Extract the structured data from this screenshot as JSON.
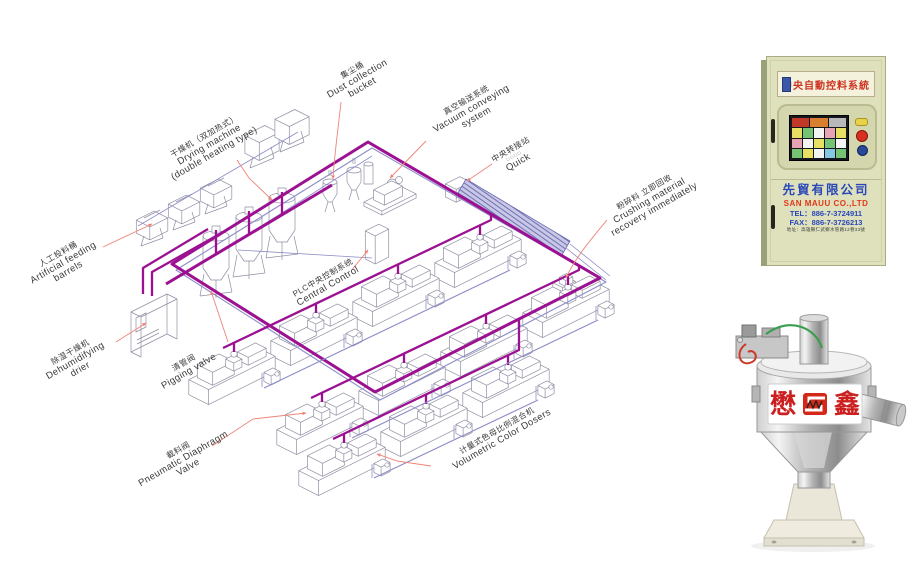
{
  "page_background": "#ffffff",
  "colors": {
    "pipe_main": "#9c1191",
    "pipe_return": "#8c8cc8",
    "leader": "#ef8377",
    "machine_outline": "#8f8fa3"
  },
  "diagram": {
    "labels": {
      "drying": {
        "zh": "干燥机（双加热式）",
        "en1": "Drying machine",
        "en2": "(double heating type)"
      },
      "dust_collection": {
        "zh": "集尘桶",
        "en1": "Dust collection",
        "en2": "bucket"
      },
      "vacuum": {
        "zh": "真空输送系统",
        "en1": "Vacuum conveying",
        "en2": "system"
      },
      "transfer": {
        "zh": "中央转接站",
        "sub": "□□□□",
        "en1": "Quick"
      },
      "artificial": {
        "zh": "人工投料桶",
        "en1": "Artificial feeding",
        "en2": "barrels"
      },
      "dehumidifying": {
        "zh": "除湿干燥机",
        "en1": "Dehumidifying",
        "en2": "drier"
      },
      "pigging": {
        "zh": "清管阀",
        "en1": "Pigging valve"
      },
      "central_control": {
        "zh": "PLC中央控制系统",
        "en1": "Central Control"
      },
      "crushing": {
        "zh": "粉碎料 立即回收",
        "en1": "Crushing material",
        "en2": "recovery immediately"
      },
      "pneumatic": {
        "zh": "截料阀",
        "en1": "Pneumatic Diaphragm",
        "en2": "Valve"
      },
      "color_dosers": {
        "zh": "计量式色母比例混合机",
        "en1": "Volumetric Color Dosers"
      }
    }
  },
  "cabinet": {
    "nameplate": "中央自動控料系統",
    "company_zh": "先貿有限公司",
    "company_en": "SAN MAUU CO.,LTD",
    "tel": "TEL：886-7-3724911",
    "fax": "FAX：886-7-3726213",
    "address": "地址：高雄縣仁武鄉水管路12巷33號"
  },
  "hopper": {
    "logo_left": "懋",
    "logo_right": "鑫"
  }
}
